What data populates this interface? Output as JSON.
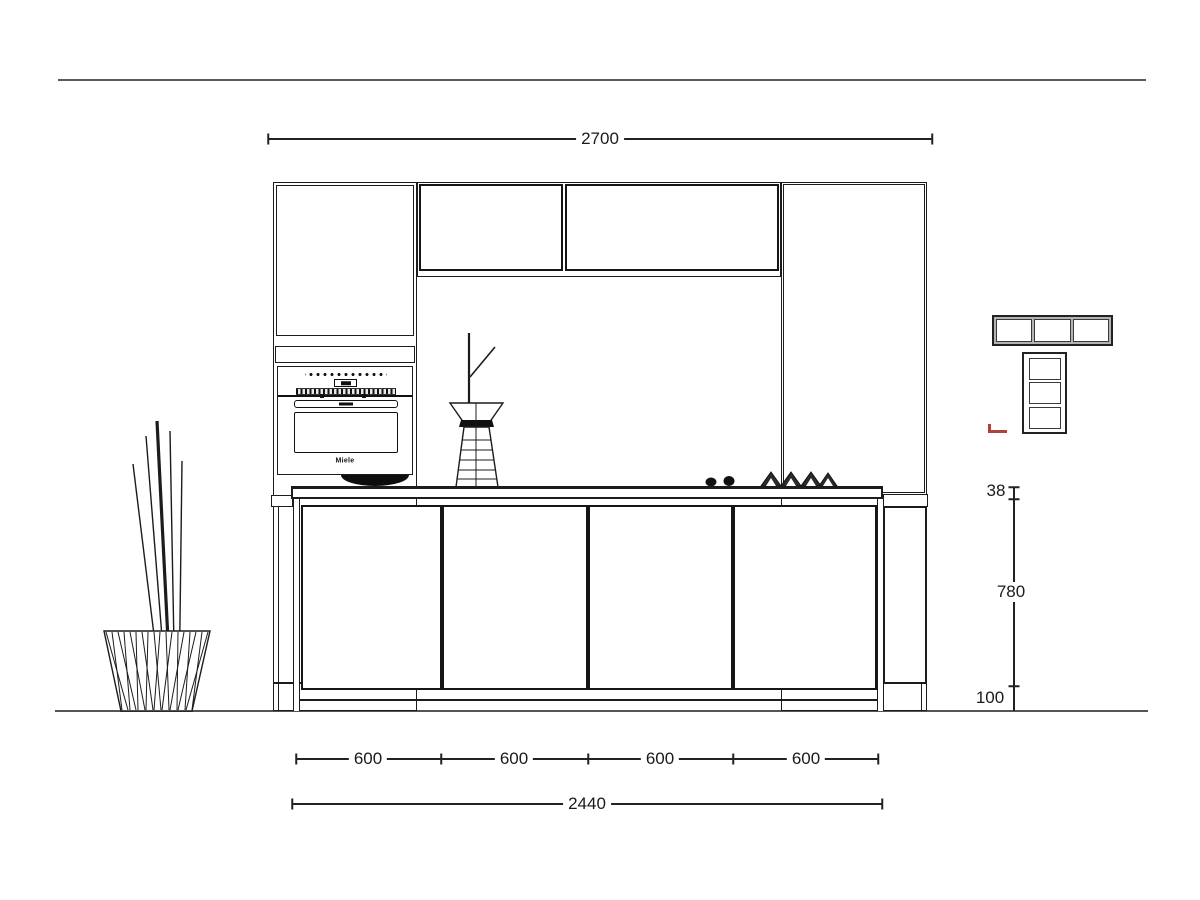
{
  "colors": {
    "line": "#1c1c1c",
    "page_rule": "#5a5a5a",
    "ground": "#555555",
    "accent_red": "#b0413e"
  },
  "dims": {
    "top_total": {
      "label": "2700"
    },
    "bottom_chain": {
      "labels": [
        "600",
        "600",
        "600",
        "600"
      ]
    },
    "bottom_total": {
      "label": "2440"
    },
    "right": {
      "counter_thickness": "38",
      "cabinet_height": "780",
      "plinth_height": "100"
    }
  },
  "appliance": {
    "brand": "Miele"
  }
}
